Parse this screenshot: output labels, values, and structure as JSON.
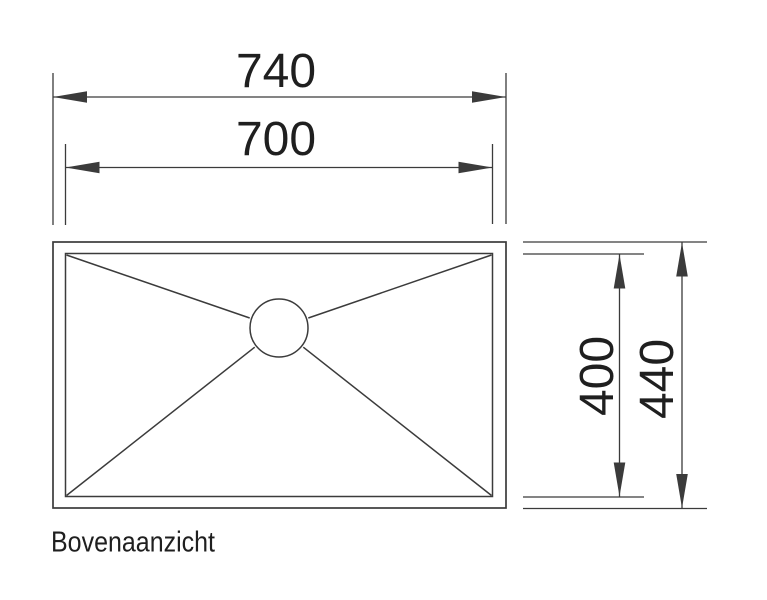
{
  "drawing": {
    "view_label": "Bovenaanzicht",
    "dimensions": {
      "top_outer_width": "740",
      "top_inner_width": "700",
      "right_inner_height": "400",
      "right_outer_height": "440"
    },
    "ink_color": "#3b3b3b",
    "text_color": "#1f1f1f"
  }
}
